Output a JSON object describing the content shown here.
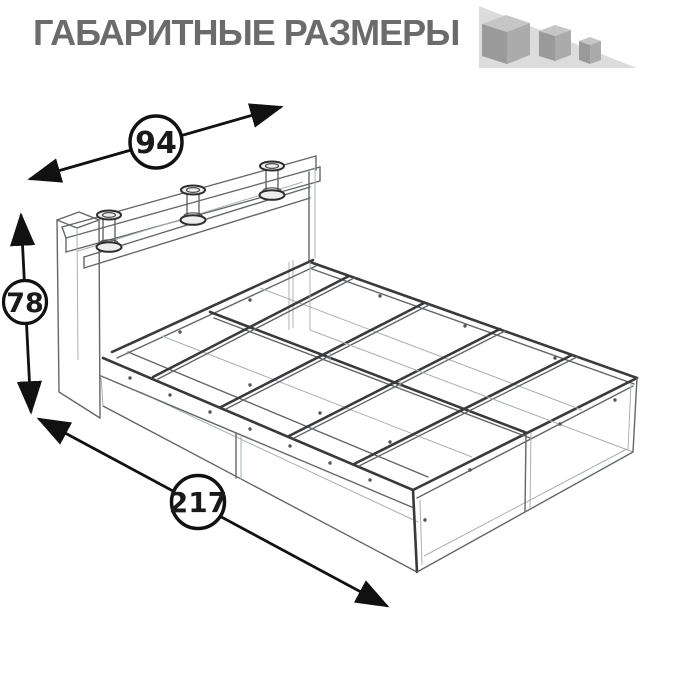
{
  "title": "ГАБАРИТНЫЕ РАЗМЕРЫ",
  "dimensions": {
    "width": "94",
    "height": "78",
    "length": "217"
  },
  "icon": {
    "name": "three-shrinking-cubes",
    "cube_count": 3
  },
  "drawing": {
    "subject": "bed-frame-isometric-sketch"
  },
  "colors": {
    "background": "#ffffff",
    "title_text": "#6b6b6b",
    "sketch_dark_line": "#3a3a3a",
    "sketch_medium_line": "#63676a",
    "sketch_faint_line": "#aab0b4",
    "dimension_ink": "#111111",
    "icon_triangle": "#dcdcdc",
    "icon_cube_top": "#c6c6c6",
    "icon_cube_front": "#9a9a9a",
    "icon_cube_side": "#ababab"
  }
}
